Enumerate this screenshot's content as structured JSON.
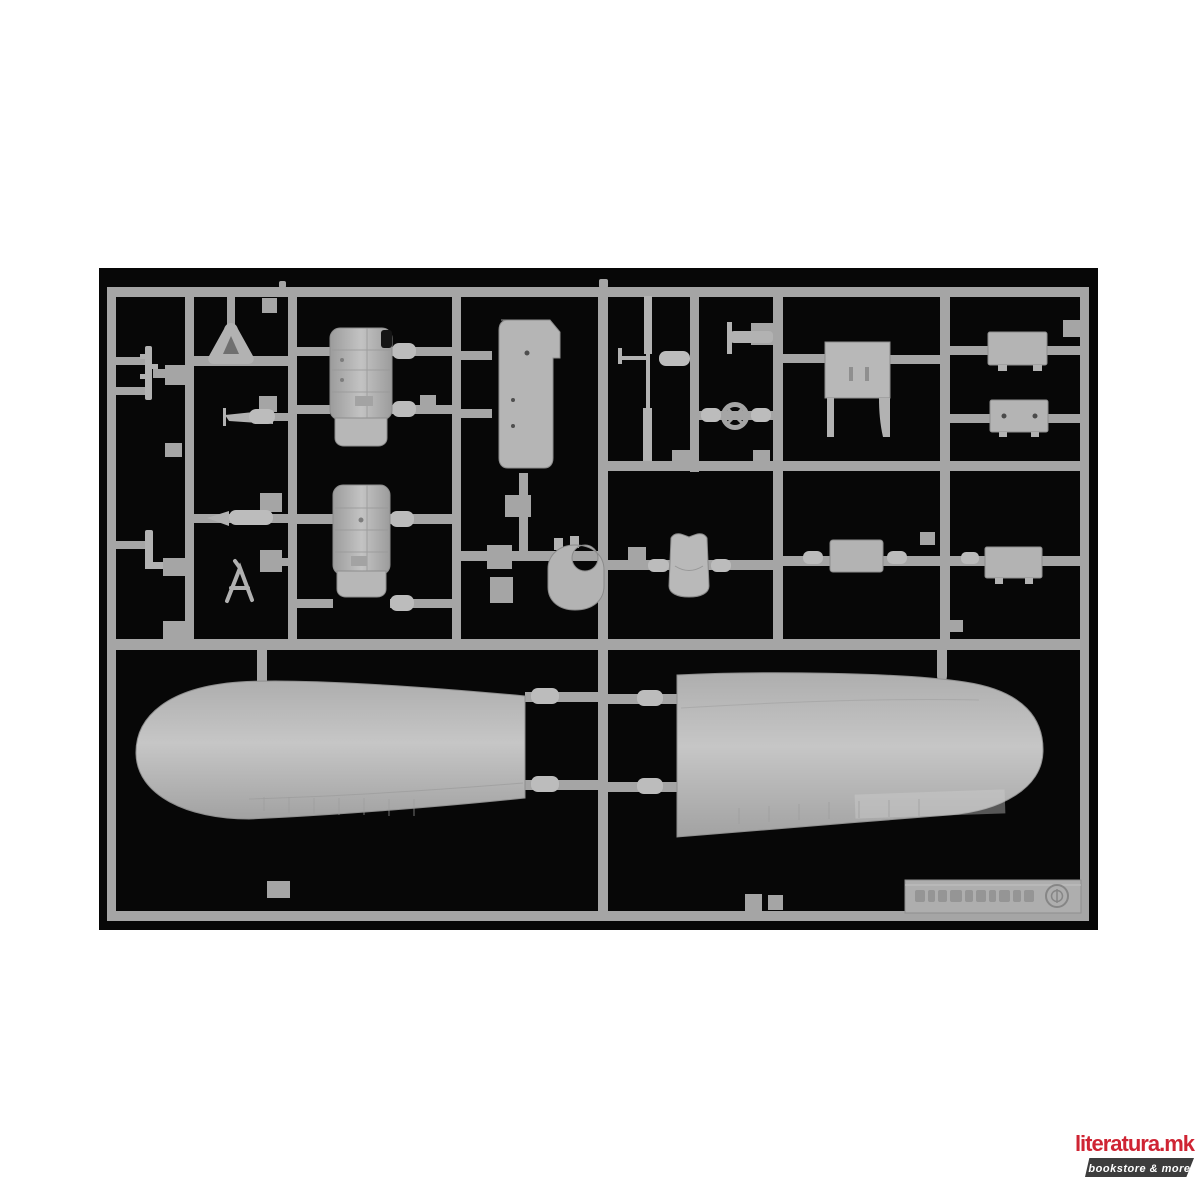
{
  "page": {
    "background": "#ffffff"
  },
  "photo": {
    "description": "Product photograph of a grey injection-moulded plastic model kit sprue (aircraft parts) on a black background",
    "parts": [
      "left-outer-wing-half",
      "right-outer-wing-half",
      "engine-cowling-half-upper",
      "engine-cowling-half-lower",
      "fuselage-floor-panel",
      "pilot-seat",
      "cockpit-bulkhead",
      "control-wheel",
      "control-column-strut",
      "equipment-box-1",
      "equipment-box-2",
      "radiator-housing-1",
      "radiator-housing-2",
      "mount-ring",
      "tail-strut-a-frame",
      "gun-barrel-rod",
      "tailwheel-triangle-bracket",
      "small-brackets-and-fittings"
    ],
    "sprue_marking": {
      "embossed_text_present": true,
      "legible": false,
      "mirrored": true,
      "symbol": "circled-emblem"
    }
  },
  "logo": {
    "title": "literatura.mk",
    "tagline": "bookstore & more"
  },
  "colors": {
    "page_bg": "#ffffff",
    "photo_bg": "#070707",
    "sprue": "#a5a5a5",
    "part": "#b2b2b2",
    "part_light": "#bcbcbc",
    "edge": "#8a8a8a",
    "logo_red": "#cf2433",
    "banner": "#3d3d3d",
    "banner_text": "#ffffff"
  }
}
